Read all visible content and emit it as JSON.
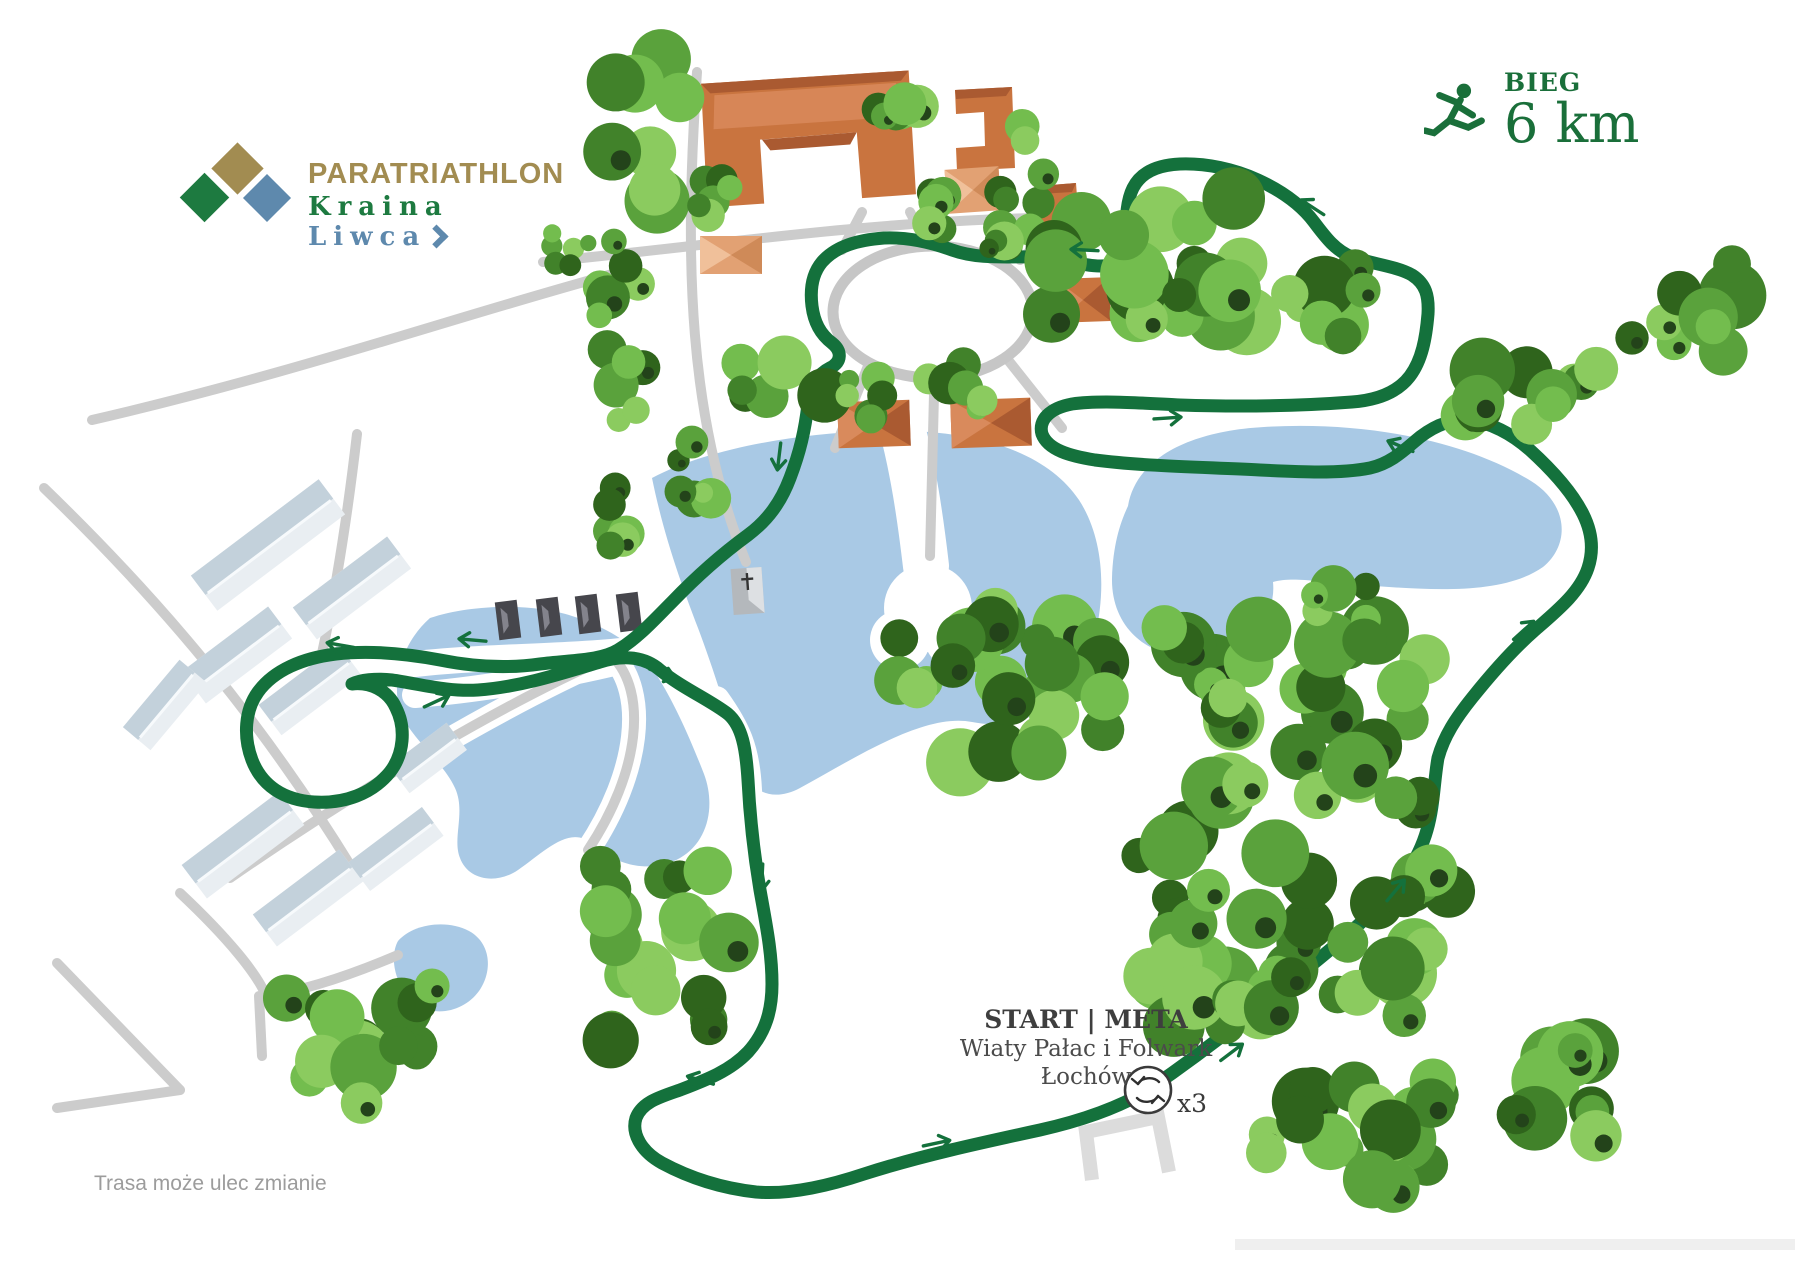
{
  "logo": {
    "title": "PARATRIATHLON",
    "subtitle_word1": "Kraina",
    "subtitle_word2": "Liwca"
  },
  "legend": {
    "label": "BIEG",
    "distance": "6 km"
  },
  "start_meta": {
    "title": "START | META",
    "venue_line1": "Wiaty Pałac i Folwark",
    "venue_line2": "Łochów",
    "laps_label": "x3"
  },
  "footer": {
    "disclaimer": "Trasa może ulec zmianie"
  },
  "icons": {
    "logo_diamonds": "logo-diamonds-icon",
    "runner": "runner-icon",
    "laps_loop": "laps-loop-icon",
    "route_arrow": "direction-arrow-icon"
  },
  "colors": {
    "route": "#14713c",
    "lake": "#a9c9e5",
    "road": "#cccccc",
    "roof_orange": "#c9743f",
    "roof_orange_light": "#e2a173",
    "roof_white_building": "#c3d1db",
    "wall_white_building": "#e9eef2",
    "dark_building": "#46464c",
    "logo_gold": "#a28c51",
    "logo_green": "#1d7a40",
    "logo_blue": "#5e89ad",
    "legend_green": "#1a6f3a",
    "label_dark": "#3e3e3e",
    "footer_gray": "#9c9c9c"
  },
  "tree_palette": [
    "#5aa23c",
    "#73bd4e",
    "#8bcb5f",
    "#41822a",
    "#2f641c"
  ]
}
